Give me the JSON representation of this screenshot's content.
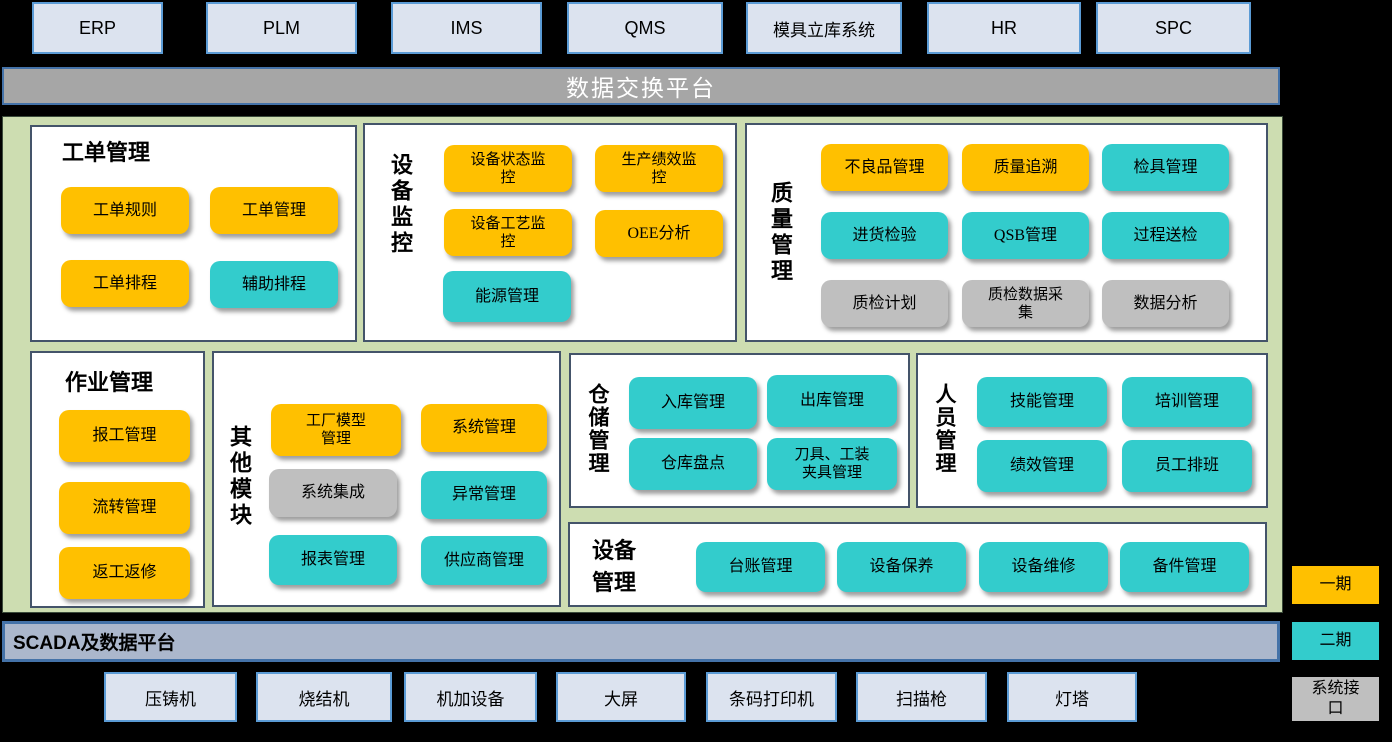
{
  "top_systems": [
    {
      "label": "ERP"
    },
    {
      "label": "PLM"
    },
    {
      "label": "IMS"
    },
    {
      "label": "QMS"
    },
    {
      "label": "模具立库系统"
    },
    {
      "label": "HR"
    },
    {
      "label": "SPC"
    }
  ],
  "platforms": {
    "exchange": {
      "label": "数据交换平台"
    },
    "scada": {
      "label": "SCADA及数据平台"
    }
  },
  "sections": [
    {
      "title": "工单管理",
      "buttons": [
        {
          "label": "工单规则",
          "phase": "phase1"
        },
        {
          "label": "工单管理",
          "phase": "phase1"
        },
        {
          "label": "工单排程",
          "phase": "phase1"
        },
        {
          "label": "辅助排程",
          "phase": "phase2"
        }
      ]
    },
    {
      "title": "设备监控",
      "buttons": [
        {
          "label": "设备状态监\n控",
          "phase": "phase1"
        },
        {
          "label": "生产绩效监\n控",
          "phase": "phase1"
        },
        {
          "label": "设备工艺监\n控",
          "phase": "phase1"
        },
        {
          "label": "OEE分析",
          "phase": "phase1"
        },
        {
          "label": "能源管理",
          "phase": "phase2"
        }
      ]
    },
    {
      "title": "质量管理",
      "buttons": [
        {
          "label": "不良品管理",
          "phase": "phase1"
        },
        {
          "label": "质量追溯",
          "phase": "phase1"
        },
        {
          "label": "检具管理",
          "phase": "phase2"
        },
        {
          "label": "进货检验",
          "phase": "phase2"
        },
        {
          "label": "QSB管理",
          "phase": "phase2"
        },
        {
          "label": "过程送检",
          "phase": "phase2"
        },
        {
          "label": "质检计划",
          "phase": "interface"
        },
        {
          "label": "质检数据采\n集",
          "phase": "interface"
        },
        {
          "label": "数据分析",
          "phase": "interface"
        }
      ]
    },
    {
      "title": "作业管理",
      "buttons": [
        {
          "label": "报工管理",
          "phase": "phase1"
        },
        {
          "label": "流转管理",
          "phase": "phase1"
        },
        {
          "label": "返工返修",
          "phase": "phase1"
        }
      ]
    },
    {
      "title": "其他模块",
      "buttons": [
        {
          "label": "工厂模型\n管理",
          "phase": "phase1"
        },
        {
          "label": "系统管理",
          "phase": "phase1"
        },
        {
          "label": "系统集成",
          "phase": "interface"
        },
        {
          "label": "异常管理",
          "phase": "phase2"
        },
        {
          "label": "报表管理",
          "phase": "phase2"
        },
        {
          "label": "供应商管理",
          "phase": "phase2"
        }
      ]
    },
    {
      "title": "仓储管理",
      "buttons": [
        {
          "label": "入库管理",
          "phase": "phase2"
        },
        {
          "label": "出库管理",
          "phase": "phase2"
        },
        {
          "label": "仓库盘点",
          "phase": "phase2"
        },
        {
          "label": "刀具、工装\n夹具管理",
          "phase": "phase2"
        }
      ]
    },
    {
      "title": "人员管理",
      "buttons": [
        {
          "label": "技能管理",
          "phase": "phase2"
        },
        {
          "label": "培训管理",
          "phase": "phase2"
        },
        {
          "label": "绩效管理",
          "phase": "phase2"
        },
        {
          "label": "员工排班",
          "phase": "phase2"
        }
      ]
    },
    {
      "title": "设备管理",
      "buttons": [
        {
          "label": "台账管理",
          "phase": "phase2"
        },
        {
          "label": "设备保养",
          "phase": "phase2"
        },
        {
          "label": "设备维修",
          "phase": "phase2"
        },
        {
          "label": "备件管理",
          "phase": "phase2"
        }
      ]
    }
  ],
  "devices": [
    {
      "label": "压铸机"
    },
    {
      "label": "烧结机"
    },
    {
      "label": "机加设备"
    },
    {
      "label": "大屏"
    },
    {
      "label": "条码打印机"
    },
    {
      "label": "扫描枪"
    },
    {
      "label": "灯塔"
    }
  ],
  "legend": {
    "phase1": {
      "label": "一期",
      "color": "#FFC000"
    },
    "phase2": {
      "label": "二期",
      "color": "#33CCCC"
    },
    "interface": {
      "label": "系统接\n口",
      "color": "#BFBFBF"
    }
  },
  "colors": {
    "phase1": "#FFC000",
    "phase2": "#33CCCC",
    "interface": "#BFBFBF",
    "system_box_fill": "#DCE3EF",
    "system_box_border": "#5B9BD5",
    "exchange_bar_fill": "#A6A6A6",
    "scada_bar_fill": "#ABB7CC",
    "bar_border": "#4472A8",
    "panel_background": "#CDDDB1",
    "section_border": "#44546A",
    "page_background": "#000000"
  }
}
